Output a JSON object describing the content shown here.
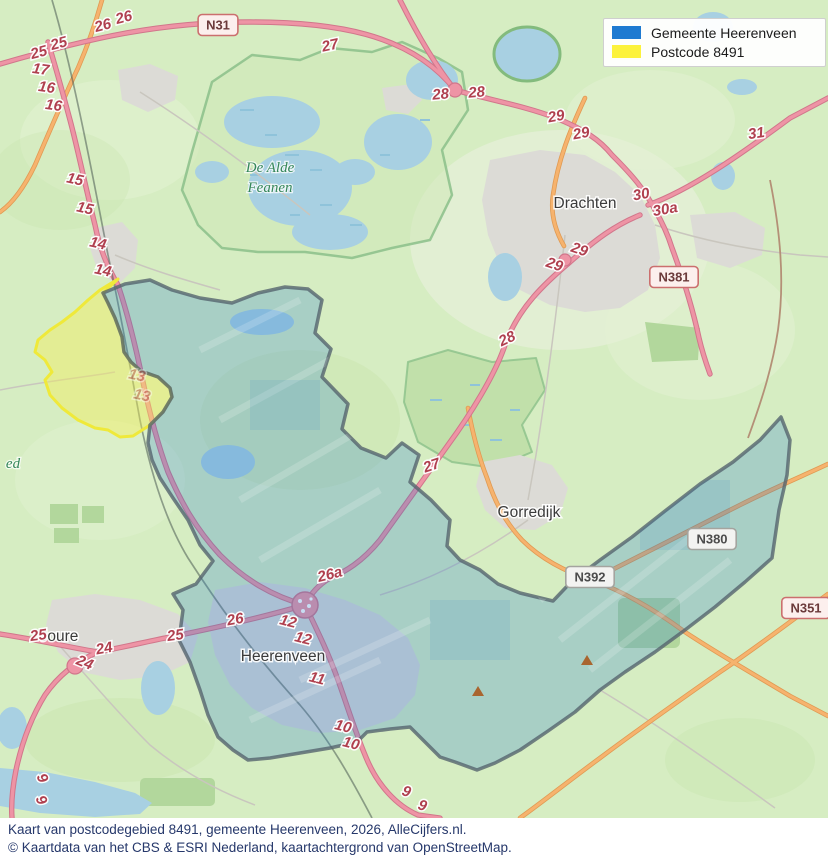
{
  "legend": {
    "items": [
      {
        "label": "Gemeente Heerenveen",
        "color": "#1e7ad1"
      },
      {
        "label": "Postcode 8491",
        "color": "#fcf23c"
      }
    ]
  },
  "caption": {
    "line1": "Kaart van postcodegebied 8491, gemeente Heerenveen, 2026, AlleCijfers.nl.",
    "line2": "© Kaartdata van het CBS & ESRI Nederland, kaartachtergrond van OpenStreetMap."
  },
  "map": {
    "place_labels": [
      {
        "text": "Drachten",
        "x": 585,
        "y": 208
      },
      {
        "text": "Gorredijk",
        "x": 529,
        "y": 517
      },
      {
        "text": "Joure",
        "x": 59,
        "y": 641
      },
      {
        "text": "Heerenveen",
        "x": 283,
        "y": 661
      }
    ],
    "nature_labels": [
      {
        "text": "De Alde",
        "x": 270,
        "y": 172
      },
      {
        "text": "Feanen",
        "x": 270,
        "y": 192
      },
      {
        "text": "ed",
        "x": 13,
        "y": 468
      }
    ],
    "road_shields": [
      {
        "text": "N31",
        "x": 218,
        "y": 25,
        "type": "red"
      },
      {
        "text": "N381",
        "x": 674,
        "y": 277,
        "type": "red"
      },
      {
        "text": "N380",
        "x": 712,
        "y": 539,
        "type": "gray"
      },
      {
        "text": "N392",
        "x": 590,
        "y": 577,
        "type": "gray"
      },
      {
        "text": "N351",
        "x": 806,
        "y": 608,
        "type": "red"
      }
    ],
    "exit_numbers": [
      {
        "t": "26",
        "x": 104,
        "y": 30,
        "r": -15
      },
      {
        "t": "26",
        "x": 125,
        "y": 22,
        "r": -15
      },
      {
        "t": "25",
        "x": 40,
        "y": 57,
        "r": -15
      },
      {
        "t": "25",
        "x": 60,
        "y": 48,
        "r": -15
      },
      {
        "t": "17",
        "x": 40,
        "y": 74,
        "r": 8
      },
      {
        "t": "16",
        "x": 46,
        "y": 92,
        "r": 8
      },
      {
        "t": "16",
        "x": 53,
        "y": 110,
        "r": 8
      },
      {
        "t": "15",
        "x": 74,
        "y": 184,
        "r": 12
      },
      {
        "t": "15",
        "x": 84,
        "y": 213,
        "r": 12
      },
      {
        "t": "14",
        "x": 97,
        "y": 248,
        "r": 12
      },
      {
        "t": "14",
        "x": 102,
        "y": 275,
        "r": 12
      },
      {
        "t": "13",
        "x": 136,
        "y": 380,
        "r": 12,
        "f": 1
      },
      {
        "t": "13",
        "x": 141,
        "y": 400,
        "r": 12,
        "f": 1
      },
      {
        "t": "27",
        "x": 331,
        "y": 50,
        "r": -12
      },
      {
        "t": "28",
        "x": 441,
        "y": 99,
        "r": -5
      },
      {
        "t": "28",
        "x": 477,
        "y": 97,
        "r": -5
      },
      {
        "t": "29",
        "x": 557,
        "y": 121,
        "r": -10
      },
      {
        "t": "29",
        "x": 582,
        "y": 138,
        "r": -10
      },
      {
        "t": "31",
        "x": 757,
        "y": 138,
        "r": -8
      },
      {
        "t": "30",
        "x": 642,
        "y": 199,
        "r": -10
      },
      {
        "t": "30a",
        "x": 666,
        "y": 214,
        "r": -10
      },
      {
        "t": "29",
        "x": 578,
        "y": 254,
        "r": 18
      },
      {
        "t": "29",
        "x": 553,
        "y": 269,
        "r": 18
      },
      {
        "t": "28",
        "x": 509,
        "y": 343,
        "r": -25
      },
      {
        "t": "27",
        "x": 433,
        "y": 470,
        "r": -18
      },
      {
        "t": "26a",
        "x": 331,
        "y": 579,
        "r": -14
      },
      {
        "t": "26",
        "x": 236,
        "y": 624,
        "r": -10
      },
      {
        "t": "25",
        "x": 176,
        "y": 640,
        "r": -8
      },
      {
        "t": "25",
        "x": 39,
        "y": 640,
        "r": -8
      },
      {
        "t": "24",
        "x": 105,
        "y": 653,
        "r": -10
      },
      {
        "t": "24",
        "x": 83,
        "y": 667,
        "r": 22
      },
      {
        "t": "12",
        "x": 287,
        "y": 626,
        "r": 14
      },
      {
        "t": "12",
        "x": 302,
        "y": 643,
        "r": 14
      },
      {
        "t": "11",
        "x": 316,
        "y": 683,
        "r": 14
      },
      {
        "t": "10",
        "x": 342,
        "y": 731,
        "r": 14
      },
      {
        "t": "10",
        "x": 350,
        "y": 748,
        "r": 14
      },
      {
        "t": "9",
        "x": 405,
        "y": 796,
        "r": 18
      },
      {
        "t": "9",
        "x": 421,
        "y": 810,
        "r": 18
      },
      {
        "t": "9",
        "x": 38,
        "y": 780,
        "r": 65
      },
      {
        "t": "9",
        "x": 37,
        "y": 802,
        "r": 65
      }
    ],
    "poi_markers": [
      {
        "x": 478,
        "y": 692
      },
      {
        "x": 587,
        "y": 661
      }
    ],
    "colors": {
      "land": "#d6edc2",
      "urban": "#dcdbd6",
      "water": "#a8d0e2",
      "motorway": "#ee94a5",
      "secondary_road": "#f6b36e",
      "municipality_fill": "#1f78d1",
      "municipality_border": "#55646e",
      "postcode_fill": "#f5ef55",
      "postcode_border": "#efe93a",
      "exit_label": "#b0404f",
      "poi_marker": "#a9652f"
    }
  }
}
